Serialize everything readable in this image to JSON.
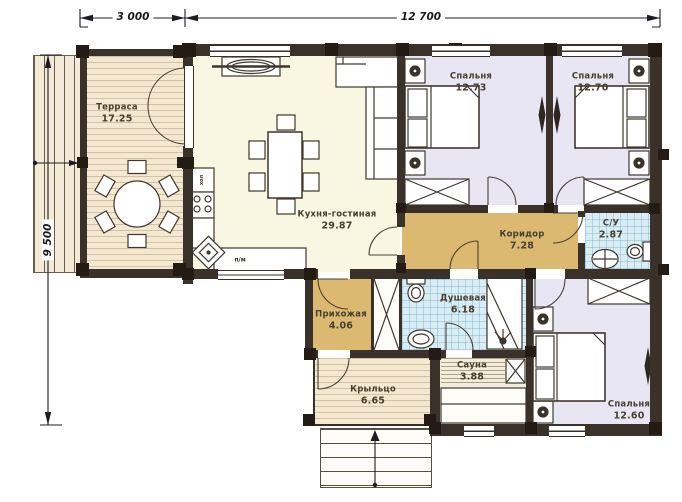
{
  "dimensions": {
    "terrace_width": "3 000",
    "main_width": "12 700",
    "total_depth": "9 500"
  },
  "rooms": [
    {
      "id": "terrace",
      "name": "Терраса",
      "area": "17.25"
    },
    {
      "id": "kitchen-living",
      "name": "Кухня-гостиная",
      "area": "29.87"
    },
    {
      "id": "bedroom-1",
      "name": "Спальня",
      "area": "12.73"
    },
    {
      "id": "bedroom-2",
      "name": "Спальня",
      "area": "12.70"
    },
    {
      "id": "corridor",
      "name": "Коридор",
      "area": "7.28"
    },
    {
      "id": "bathroom",
      "name": "С/У",
      "area": "2.87"
    },
    {
      "id": "shower",
      "name": "Душевая",
      "area": "6.18"
    },
    {
      "id": "hallway",
      "name": "Прихожая",
      "area": "4.06"
    },
    {
      "id": "sauna",
      "name": "Сауна",
      "area": "3.88"
    },
    {
      "id": "bedroom-3",
      "name": "Спальня",
      "area": "12.60"
    },
    {
      "id": "porch",
      "name": "Крыльцо",
      "area": "6.65"
    }
  ],
  "appliances": {
    "fridge": "хол",
    "dishwasher": "п/м"
  },
  "colors": {
    "wall": "#3a312a",
    "post": "#231b14",
    "terrace": "#f4e8d0",
    "living": "#f9f7e1",
    "bedroom": "#e9e6f4",
    "corridor": "#dcb971",
    "wet": "#d9edf4",
    "sauna": "#f3eed9"
  }
}
